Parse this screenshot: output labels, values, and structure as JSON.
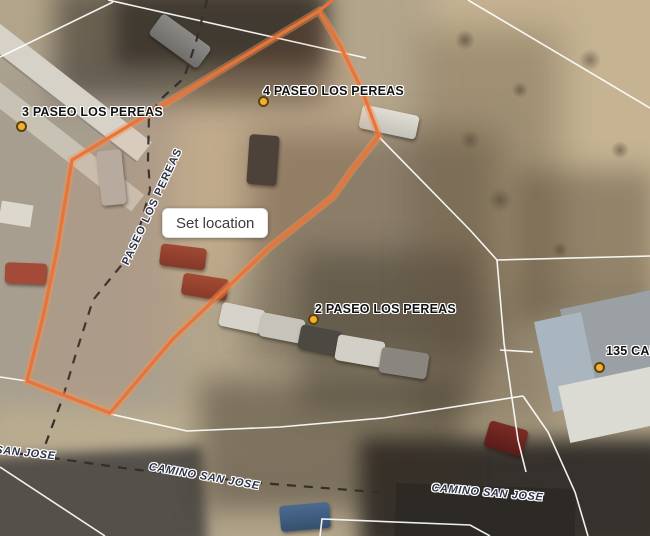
{
  "map": {
    "tooltip": {
      "label": "Set location"
    },
    "address_labels": [
      {
        "text": "3 PASEO LOS PEREAS"
      },
      {
        "text": "4 PASEO LOS PEREAS"
      },
      {
        "text": "2 PASEO LOS PEREAS"
      },
      {
        "text": "135 CAM"
      }
    ],
    "street_labels": [
      {
        "text": "PASEO LOS PEREAS"
      },
      {
        "text": "CAMINO SAN JOSE"
      },
      {
        "text": "CAMINO SAN JOSE"
      },
      {
        "text": "SAN JOSE"
      }
    ],
    "colors": {
      "selected_parcel": "#e8743b",
      "parcel_lines": "#ffffff",
      "road_centerline": "#332f2a",
      "address_marker": "#f4b02a"
    }
  }
}
